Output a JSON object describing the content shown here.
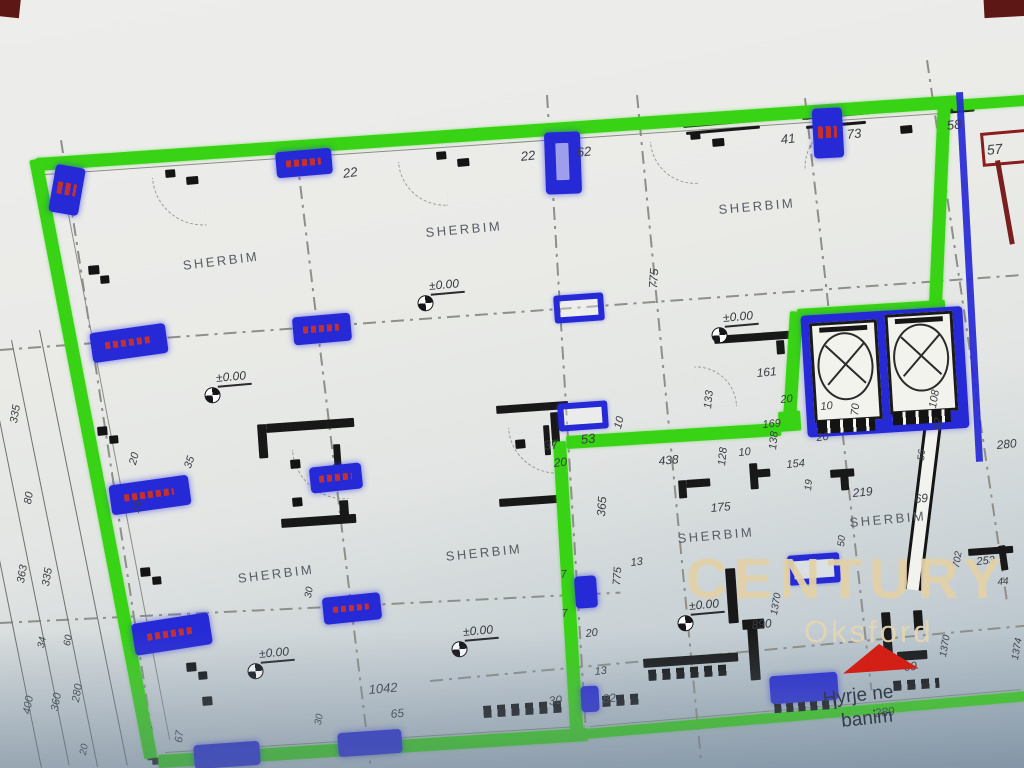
{
  "photo": {
    "description": "Photographed CAD floor plan on a computer screen, unit boundary highlighted in green, openings highlighted in blue"
  },
  "watermark": {
    "brand": "CENTURY 21",
    "reg": "®",
    "office": "Oksford"
  },
  "entrance": {
    "line1": "Hyrje ne",
    "line2": "banim"
  },
  "room_label": "SHERBIM",
  "elevation_label": "±0.00",
  "colors": {
    "boundary_green": "#38d314",
    "highlight_blue": "#2629d6",
    "wall_black": "#181818",
    "dimension_text": "#3a3d42",
    "watermark_cream": "#e2d1a8",
    "entrance_arrow_red": "#d22017",
    "alert_red_box": "#8a1d1d"
  },
  "rooms": [
    {
      "x": 182,
      "y": 258,
      "r": -7
    },
    {
      "x": 425,
      "y": 225,
      "r": -5
    },
    {
      "x": 718,
      "y": 202,
      "r": -5
    },
    {
      "x": 237,
      "y": 571,
      "r": -7
    },
    {
      "x": 445,
      "y": 549,
      "r": -6
    },
    {
      "x": 677,
      "y": 531,
      "r": -5
    },
    {
      "x": 849,
      "y": 515,
      "r": -5
    }
  ],
  "elevation_points": [
    {
      "x": 203,
      "y": 378,
      "r": -5
    },
    {
      "x": 416,
      "y": 286,
      "r": -5
    },
    {
      "x": 710,
      "y": 318,
      "r": -5
    },
    {
      "x": 246,
      "y": 654,
      "r": -5
    },
    {
      "x": 450,
      "y": 632,
      "r": -5
    },
    {
      "x": 676,
      "y": 606,
      "r": -5
    }
  ],
  "dim_labels": [
    {
      "t": "22",
      "x": 342,
      "y": 166,
      "r": -8,
      "s": 13
    },
    {
      "t": "22",
      "x": 520,
      "y": 149,
      "r": -6,
      "s": 13
    },
    {
      "t": "62",
      "x": 576,
      "y": 145,
      "r": -6,
      "s": 13
    },
    {
      "t": "41",
      "x": 780,
      "y": 132,
      "r": -6,
      "s": 13
    },
    {
      "t": "73",
      "x": 846,
      "y": 127,
      "r": -6,
      "s": 13
    },
    {
      "t": "58",
      "x": 946,
      "y": 118,
      "r": -6,
      "s": 13
    },
    {
      "t": "57",
      "x": 986,
      "y": 142,
      "r": -6,
      "s": 14
    },
    {
      "t": "775",
      "x": 646,
      "y": 288,
      "r": -86,
      "s": 12
    },
    {
      "t": "161",
      "x": 756,
      "y": 366,
      "r": -5,
      "s": 12
    },
    {
      "t": "20",
      "x": 780,
      "y": 394,
      "r": -5,
      "s": 11
    },
    {
      "t": "133",
      "x": 702,
      "y": 408,
      "r": -84,
      "s": 11
    },
    {
      "t": "169",
      "x": 762,
      "y": 419,
      "r": -5,
      "s": 11
    },
    {
      "t": "10",
      "x": 820,
      "y": 401,
      "r": -5,
      "s": 11
    },
    {
      "t": "70",
      "x": 849,
      "y": 415,
      "r": -84,
      "s": 11
    },
    {
      "t": "20",
      "x": 816,
      "y": 432,
      "r": -5,
      "s": 11
    },
    {
      "t": "108",
      "x": 927,
      "y": 407,
      "r": -80,
      "s": 11
    },
    {
      "t": "52",
      "x": 931,
      "y": 429,
      "r": -80,
      "s": 11
    },
    {
      "t": "280",
      "x": 996,
      "y": 438,
      "r": -5,
      "s": 12
    },
    {
      "t": "56",
      "x": 916,
      "y": 460,
      "r": -84,
      "s": 10
    },
    {
      "t": "69",
      "x": 914,
      "y": 492,
      "r": -5,
      "s": 12
    },
    {
      "t": "253",
      "x": 976,
      "y": 556,
      "r": -5,
      "s": 11
    },
    {
      "t": "702",
      "x": 951,
      "y": 567,
      "r": -80,
      "s": 10
    },
    {
      "t": "44",
      "x": 997,
      "y": 577,
      "r": -5,
      "s": 10
    },
    {
      "t": "438",
      "x": 658,
      "y": 454,
      "r": -5,
      "s": 12
    },
    {
      "t": "10",
      "x": 738,
      "y": 447,
      "r": -5,
      "s": 11
    },
    {
      "t": "128",
      "x": 716,
      "y": 465,
      "r": -84,
      "s": 11
    },
    {
      "t": "138",
      "x": 767,
      "y": 449,
      "r": -84,
      "s": 11
    },
    {
      "t": "154",
      "x": 786,
      "y": 459,
      "r": -5,
      "s": 11
    },
    {
      "t": "19",
      "x": 803,
      "y": 490,
      "r": -84,
      "s": 10
    },
    {
      "t": "175",
      "x": 710,
      "y": 501,
      "r": -5,
      "s": 12
    },
    {
      "t": "219",
      "x": 852,
      "y": 486,
      "r": -5,
      "s": 12
    },
    {
      "t": "50",
      "x": 836,
      "y": 546,
      "r": -84,
      "s": 10
    },
    {
      "t": "37",
      "x": 543,
      "y": 438,
      "r": -6,
      "s": 13
    },
    {
      "t": "53",
      "x": 580,
      "y": 432,
      "r": -6,
      "s": 13
    },
    {
      "t": "10",
      "x": 612,
      "y": 427,
      "r": -75,
      "s": 11
    },
    {
      "t": "20",
      "x": 553,
      "y": 456,
      "r": -6,
      "s": 12
    },
    {
      "t": "365",
      "x": 594,
      "y": 516,
      "r": -86,
      "s": 12
    },
    {
      "t": "13",
      "x": 630,
      "y": 557,
      "r": -6,
      "s": 11
    },
    {
      "t": "7",
      "x": 560,
      "y": 569,
      "r": -6,
      "s": 11
    },
    {
      "t": "775",
      "x": 611,
      "y": 585,
      "r": -86,
      "s": 11
    },
    {
      "t": "7",
      "x": 561,
      "y": 608,
      "r": -6,
      "s": 11
    },
    {
      "t": "20",
      "x": 585,
      "y": 628,
      "r": -6,
      "s": 11
    },
    {
      "t": "13",
      "x": 594,
      "y": 666,
      "r": -6,
      "s": 11
    },
    {
      "t": "30",
      "x": 548,
      "y": 694,
      "r": -6,
      "s": 12
    },
    {
      "t": "82",
      "x": 602,
      "y": 692,
      "r": -6,
      "s": 12
    },
    {
      "t": "1042",
      "x": 368,
      "y": 682,
      "r": -5,
      "s": 13
    },
    {
      "t": "65",
      "x": 390,
      "y": 707,
      "r": -5,
      "s": 12
    },
    {
      "t": "67",
      "x": 173,
      "y": 742,
      "r": -84,
      "s": 11
    },
    {
      "t": "30",
      "x": 303,
      "y": 597,
      "r": -80,
      "s": 10
    },
    {
      "t": "30",
      "x": 313,
      "y": 724,
      "r": -80,
      "s": 10
    },
    {
      "t": "890",
      "x": 751,
      "y": 618,
      "r": -5,
      "s": 12
    },
    {
      "t": "69",
      "x": 903,
      "y": 660,
      "r": -5,
      "s": 12
    },
    {
      "t": "289",
      "x": 874,
      "y": 706,
      "r": -5,
      "s": 12
    },
    {
      "t": "1370",
      "x": 769,
      "y": 614,
      "r": -80,
      "s": 10
    },
    {
      "t": "1370",
      "x": 938,
      "y": 656,
      "r": -80,
      "s": 10
    },
    {
      "t": "1374",
      "x": 1010,
      "y": 659,
      "r": -80,
      "s": 10
    },
    {
      "t": "20",
      "x": 127,
      "y": 463,
      "r": -75,
      "s": 11
    },
    {
      "t": "19",
      "x": 130,
      "y": 511,
      "r": -75,
      "s": 11
    },
    {
      "t": "35",
      "x": 182,
      "y": 466,
      "r": -70,
      "s": 11
    },
    {
      "t": "335",
      "x": 8,
      "y": 422,
      "r": -80,
      "s": 11
    },
    {
      "t": "80",
      "x": 22,
      "y": 503,
      "r": -80,
      "s": 11
    },
    {
      "t": "363",
      "x": 15,
      "y": 582,
      "r": -80,
      "s": 11
    },
    {
      "t": "335",
      "x": 40,
      "y": 585,
      "r": -80,
      "s": 11
    },
    {
      "t": "34",
      "x": 36,
      "y": 647,
      "r": -80,
      "s": 10
    },
    {
      "t": "60",
      "x": 62,
      "y": 645,
      "r": -80,
      "s": 10
    },
    {
      "t": "400",
      "x": 21,
      "y": 713,
      "r": -80,
      "s": 11
    },
    {
      "t": "360",
      "x": 49,
      "y": 710,
      "r": -80,
      "s": 11
    },
    {
      "t": "280",
      "x": 70,
      "y": 701,
      "r": -80,
      "s": 11
    },
    {
      "t": "20",
      "x": 78,
      "y": 754,
      "r": -80,
      "s": 10
    }
  ],
  "wall_marks": [
    {
      "x": 88,
      "y": 266,
      "w": 11,
      "h": 9
    },
    {
      "x": 100,
      "y": 276,
      "w": 9,
      "h": 8
    },
    {
      "x": 97,
      "y": 427,
      "w": 10,
      "h": 9
    },
    {
      "x": 109,
      "y": 436,
      "w": 9,
      "h": 8
    },
    {
      "x": 140,
      "y": 568,
      "w": 10,
      "h": 9
    },
    {
      "x": 152,
      "y": 577,
      "w": 9,
      "h": 8
    },
    {
      "x": 186,
      "y": 663,
      "w": 10,
      "h": 9
    },
    {
      "x": 198,
      "y": 672,
      "w": 9,
      "h": 8
    },
    {
      "x": 202,
      "y": 697,
      "w": 10,
      "h": 9
    },
    {
      "x": 165,
      "y": 170,
      "w": 10,
      "h": 8
    },
    {
      "x": 186,
      "y": 177,
      "w": 12,
      "h": 8
    },
    {
      "x": 436,
      "y": 152,
      "w": 10,
      "h": 8
    },
    {
      "x": 457,
      "y": 159,
      "w": 12,
      "h": 8
    },
    {
      "x": 690,
      "y": 132,
      "w": 10,
      "h": 8
    },
    {
      "x": 712,
      "y": 139,
      "w": 12,
      "h": 8
    },
    {
      "x": 900,
      "y": 126,
      "w": 12,
      "h": 8
    },
    {
      "x": 515,
      "y": 440,
      "w": 10,
      "h": 9
    },
    {
      "x": 290,
      "y": 460,
      "w": 10,
      "h": 9
    },
    {
      "x": 292,
      "y": 498,
      "w": 10,
      "h": 9
    }
  ]
}
